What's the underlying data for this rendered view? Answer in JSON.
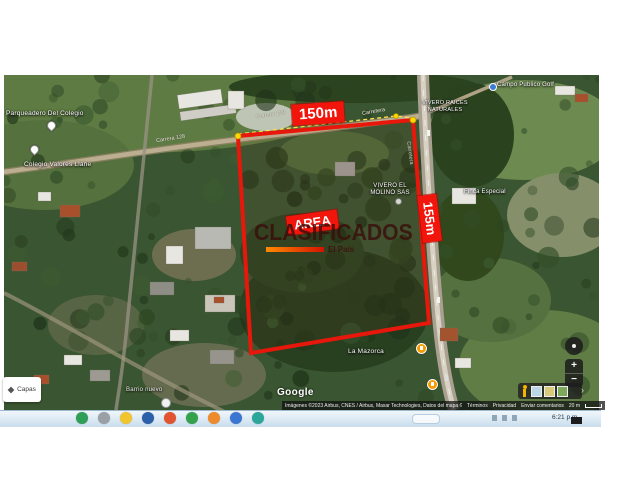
{
  "map": {
    "labels": {
      "parqueadero": "Parqueadero Del Colegio",
      "colegio": "Colegio Valores Llane",
      "carrera_top": "Carrera 128",
      "carrera_left": "Carrera 128",
      "carretera_top": "Carretera",
      "carretera_side": "Carretera",
      "vivero_molino_line1": "VIVERO EL",
      "vivero_molino_line2": "MOLINO SAS",
      "vivero_raices_line1": "VIVERO RAICES",
      "vivero_raices_line2": "NATURALES",
      "finca": "Finca Especial",
      "mazorca": "La Mazorca",
      "barrio": "Barrio nuevo",
      "golf": "Campo Publico Golf"
    },
    "measurements": {
      "top_side": "150m",
      "right_side": "155m",
      "area_tag": "AREA"
    },
    "watermark": {
      "title": "CLASIFICADOS",
      "subtitle": "El País"
    },
    "google_logo": "Google",
    "attribution": {
      "imagery": "Imágenes ©2023 Airbus, CNES / Airbus, Maxar Technologies, Datos del mapa ©2023",
      "terms": "Términos",
      "privacy": "Privacidad",
      "feedback": "Enviar comentarios",
      "scale": "20 m"
    },
    "controls": {
      "layers": "Capas",
      "zoom_in": "+",
      "zoom_out": "−"
    },
    "colors": {
      "boundary": "#e8170b",
      "measure_label_bg": "#f2150b",
      "measure_dot": "#ffd900"
    }
  },
  "taskbar": {
    "time": "6:21 p.m.",
    "app_icon_colors": [
      "#2f9e57",
      "#9aa0a6",
      "#f2c42d",
      "#2b5fa8",
      "#e25330",
      "#34a24a",
      "#ef8b2a",
      "#3b76d2",
      "#2aa69a"
    ]
  }
}
